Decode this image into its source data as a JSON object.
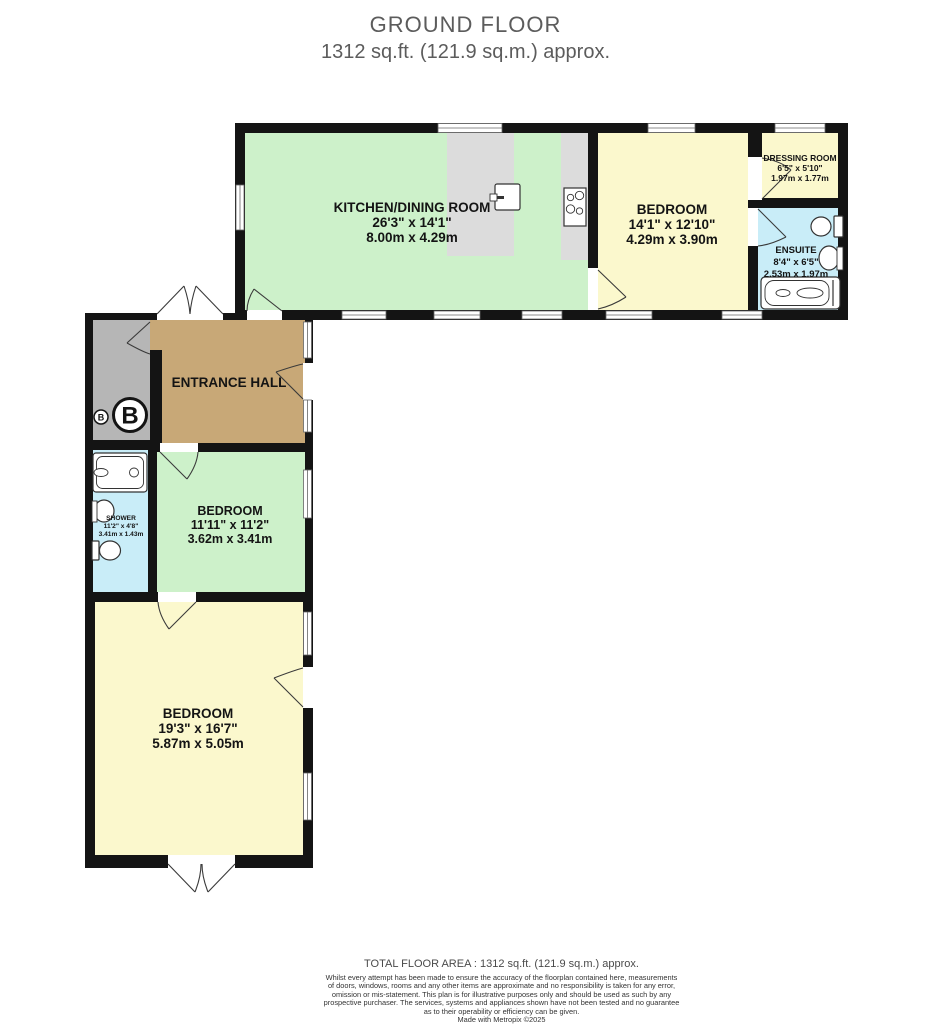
{
  "title": {
    "floor": "GROUND FLOOR",
    "area": "1312 sq.ft. (121.9 sq.m.) approx."
  },
  "rooms": {
    "kitchen": {
      "name": "KITCHEN/DINING ROOM",
      "imperial": "26'3\" x 14'1\"",
      "metric": "8.00m x 4.29m"
    },
    "bedroom1": {
      "name": "BEDROOM",
      "imperial": "14'1\" x 12'10\"",
      "metric": "4.29m x 3.90m"
    },
    "dressing": {
      "name": "DRESSING ROOM",
      "imperial": "6'5\" x 5'10\"",
      "metric": "1.97m x 1.77m"
    },
    "ensuite": {
      "name": "ENSUITE",
      "imperial": "8'4\" x 6'5\"",
      "metric": "2.53m x 1.97m"
    },
    "hall": {
      "name": "ENTRANCE HALL"
    },
    "bedroom2": {
      "name": "BEDROOM",
      "imperial": "11'11\" x 11'2\"",
      "metric": "3.62m x 3.41m"
    },
    "shower": {
      "name": "SHOWER",
      "imperial": "11'2\" x 4'8\"",
      "metric": "3.41m x 1.43m"
    },
    "bedroom3": {
      "name": "BEDROOM",
      "imperial": "19'3\" x 16'7\"",
      "metric": "5.87m x 5.05m"
    },
    "boiler": {
      "label": "B"
    }
  },
  "colors": {
    "wall": "#141414",
    "room_green": "#cdf1ca",
    "room_yellow": "#fbf8cd",
    "room_cyan": "#c9edf8",
    "room_tan": "#c8a877",
    "room_gray": "#b6b6b6",
    "counter_gray": "#dcdcdc",
    "white": "#ffffff"
  },
  "icons": [
    "kitchen-sink-icon",
    "hob-icon",
    "toilet-icon",
    "basin-icon",
    "bath-icon",
    "shower-tray-icon",
    "boiler-icon",
    "door-swing-icon",
    "window-icon"
  ],
  "footer": {
    "total": "TOTAL FLOOR AREA : 1312 sq.ft. (121.9 sq.m.) approx.",
    "disclaimer": [
      "Whilst every attempt has been made to ensure the accuracy of the floorplan contained here, measurements",
      "of doors, windows, rooms and any other items are approximate and no responsibility is taken for any error,",
      "omission or mis-statement. This plan is for illustrative purposes only and should be used as such by any",
      "prospective purchaser. The services, systems and appliances shown have not been tested and no guarantee",
      "as to their operability or efficiency can be given."
    ],
    "credit": "Made with Metropix ©2025"
  }
}
